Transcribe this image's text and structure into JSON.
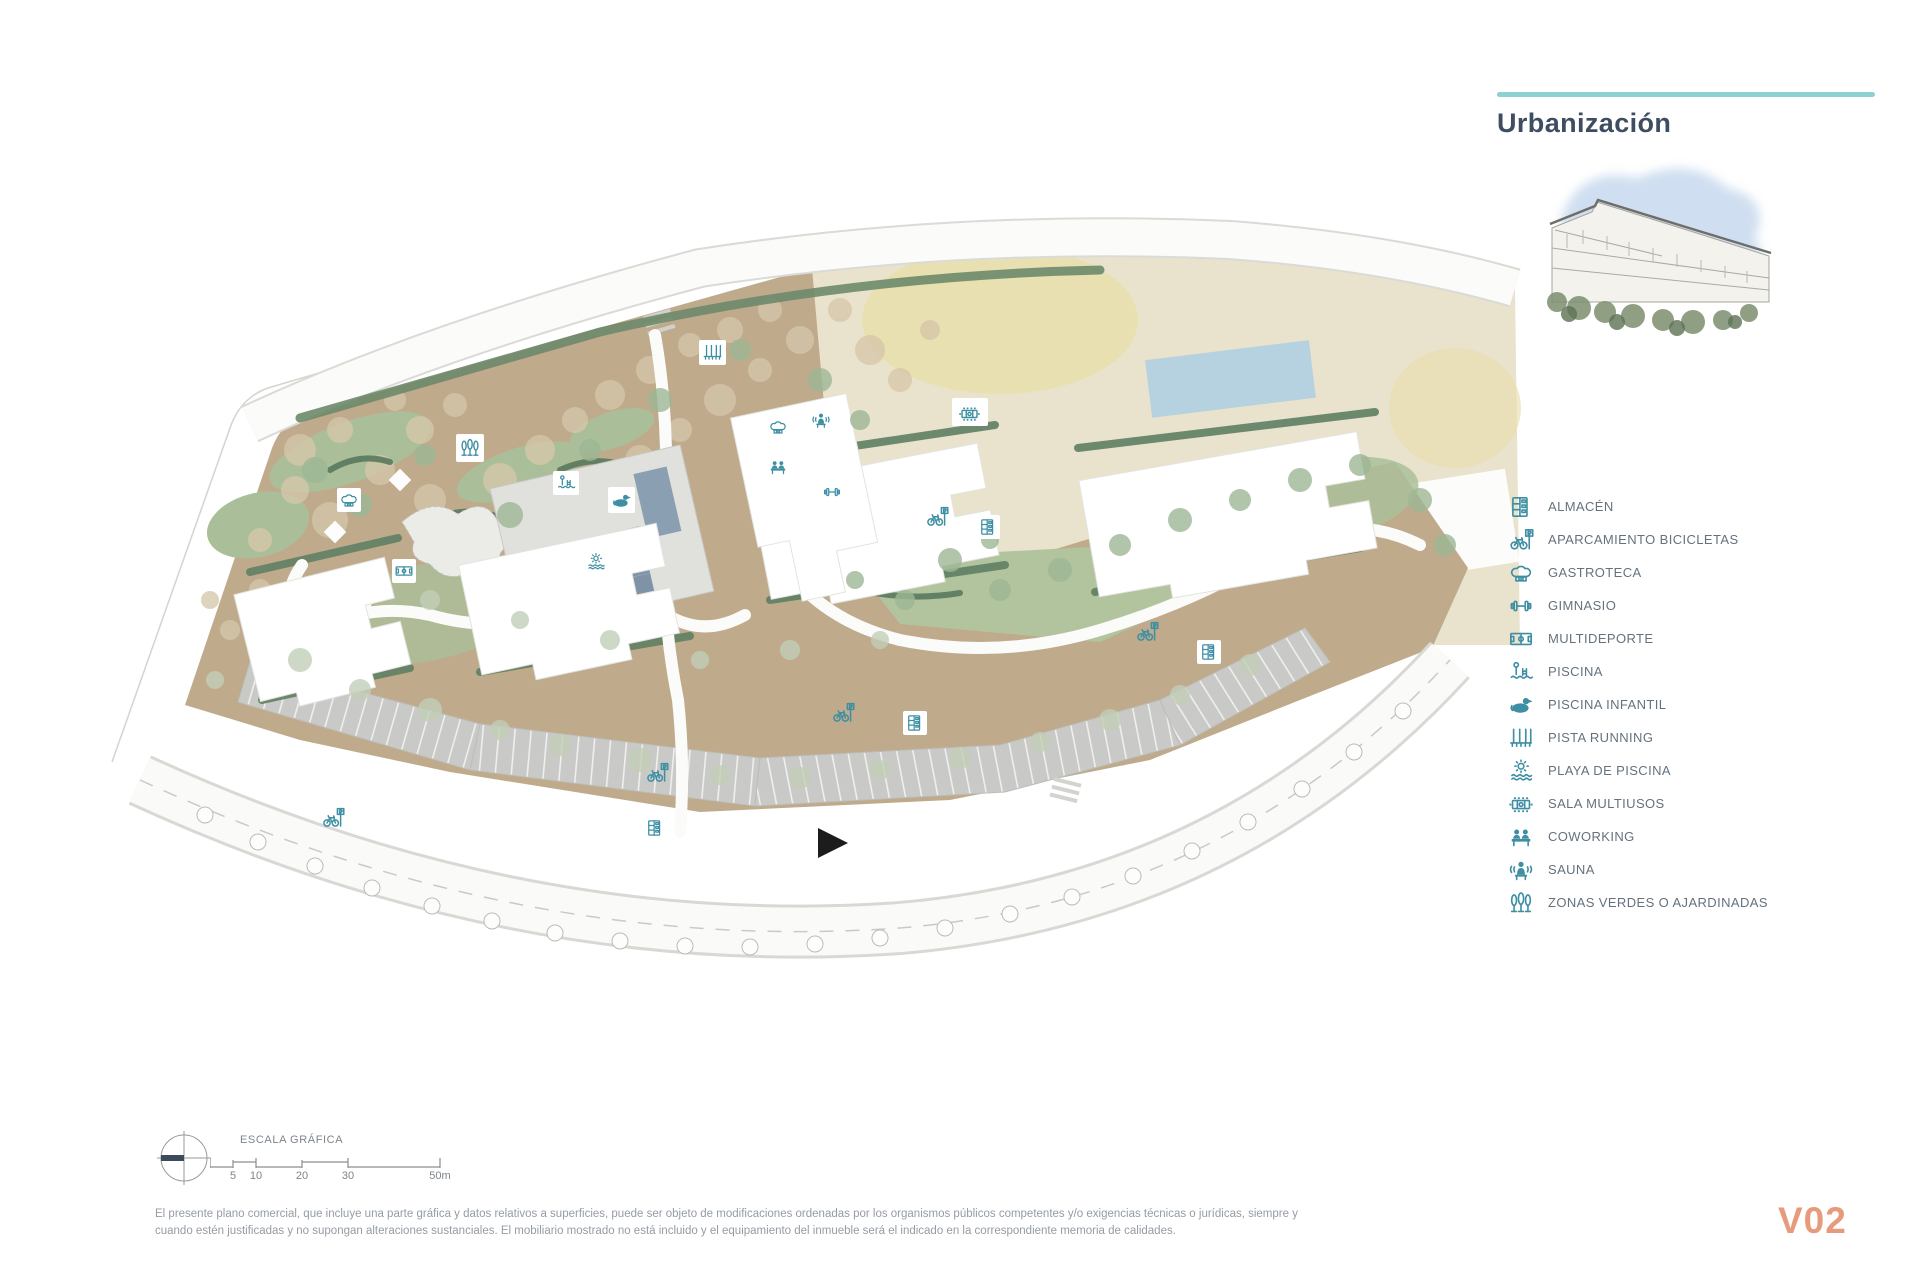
{
  "header": {
    "title": "Urbanización"
  },
  "legend": {
    "items": [
      {
        "icon": "almacen-icon",
        "label": "ALMACÉN"
      },
      {
        "icon": "bike-parking-icon",
        "label": "APARCAMIENTO BICICLETAS"
      },
      {
        "icon": "gastroteca-icon",
        "label": "GASTROTECA"
      },
      {
        "icon": "gym-icon",
        "label": "GIMNASIO"
      },
      {
        "icon": "multisport-icon",
        "label": "MULTIDEPORTE"
      },
      {
        "icon": "pool-icon",
        "label": "PISCINA"
      },
      {
        "icon": "kids-pool-icon",
        "label": "PISCINA INFANTIL"
      },
      {
        "icon": "running-track-icon",
        "label": "PISTA RUNNING"
      },
      {
        "icon": "pool-beach-icon",
        "label": "PLAYA DE PISCINA"
      },
      {
        "icon": "multiuse-room-icon",
        "label": "SALA MULTIUSOS"
      },
      {
        "icon": "coworking-icon",
        "label": "COWORKING"
      },
      {
        "icon": "sauna-icon",
        "label": "SAUNA"
      },
      {
        "icon": "green-areas-icon",
        "label": "ZONAS VERDES O AJARDINADAS"
      }
    ]
  },
  "scale_bar": {
    "title": "ESCALA GRÁFICA",
    "ticks": [
      "5",
      "10",
      "20",
      "30",
      "50m"
    ]
  },
  "footer": {
    "disclaimer_line1": "El presente plano comercial, que incluye una parte gráfica y datos relativos a superficies, puede ser objeto de modificaciones ordenadas por los organismos públicos competentes y/o exigencias técnicas o jurídicas, siempre y",
    "disclaimer_line2": "cuando estén justificadas y no supongan alteraciones sustanciales. El mobiliario mostrado no está incluido y el equipamiento del inmueble será el indicado en la correspondiente memoria de calidades.",
    "version": "V02"
  },
  "colors": {
    "accent_teal_rule": "#8ed0d1",
    "icon_teal": "#3e8fa3",
    "title_blue": "#3f4d63",
    "version_salmon": "#e79a7c",
    "landscape_brown": "#bfab8c",
    "neighbor_beige": "#e9e3cd",
    "parking_gray": "#c9c9c7",
    "pool_blue": "#7e93a6"
  }
}
